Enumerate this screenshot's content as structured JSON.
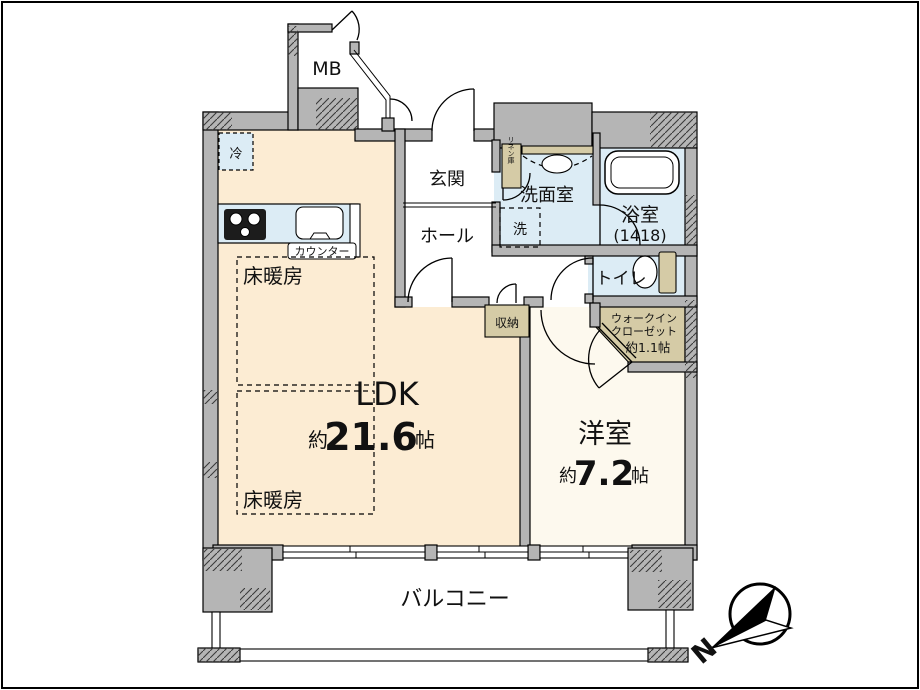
{
  "colors": {
    "wall": "#b5b5b5",
    "ldk": "#fcecd3",
    "wet": "#dcecf5",
    "tan": "#d5cba6",
    "yo": "#fdf9ee",
    "line": "#111111"
  },
  "rooms": {
    "mb": {
      "label": "MB"
    },
    "genkan": {
      "label": "玄関"
    },
    "hall": {
      "label": "ホール"
    },
    "senmen": {
      "label": "洗面室"
    },
    "bath": {
      "label": "浴室",
      "size": "(1418)"
    },
    "toilet": {
      "label": "トイレ"
    },
    "wic": {
      "line1": "ウォークイン",
      "line2": "クローゼット",
      "size": "約1.1帖"
    },
    "shuno": {
      "label": "収納"
    },
    "linen": {
      "label": "リネン庫"
    },
    "ldk": {
      "label": "LDK",
      "size_prefix": "約",
      "size_value": "21.6",
      "size_unit": "帖"
    },
    "youshitsu": {
      "label": "洋室",
      "size_prefix": "約",
      "size_value": "7.2",
      "size_unit": "帖"
    },
    "balcony": {
      "label": "バルコニー"
    }
  },
  "fixtures": {
    "fridge": "冷",
    "counter": "カウンター",
    "washer": "洗",
    "floor_heating_1": "床暖房",
    "floor_heating_2": "床暖房"
  },
  "compass": {
    "north": "N"
  }
}
